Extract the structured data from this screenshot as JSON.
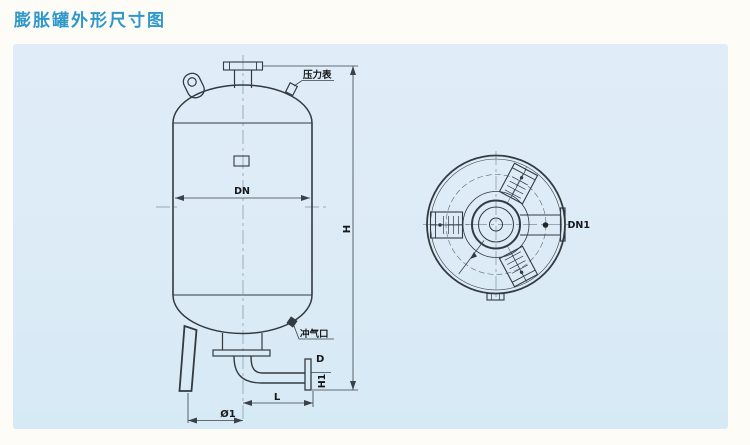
{
  "title": "膨胀罐外形尺寸图",
  "colors": {
    "title_accent": "#2f98ca",
    "panel_background": "#dcebf6",
    "line_color": "#333a40"
  },
  "front_view": {
    "labels": {
      "pressure_gauge": "压力表",
      "dn": "DN",
      "h": "H",
      "air_inlet": "冲气口",
      "d": "D",
      "h1": "H1",
      "l": "L",
      "phi1": "Ø1"
    }
  },
  "top_view": {
    "labels": {
      "dn1": "DN1"
    }
  }
}
